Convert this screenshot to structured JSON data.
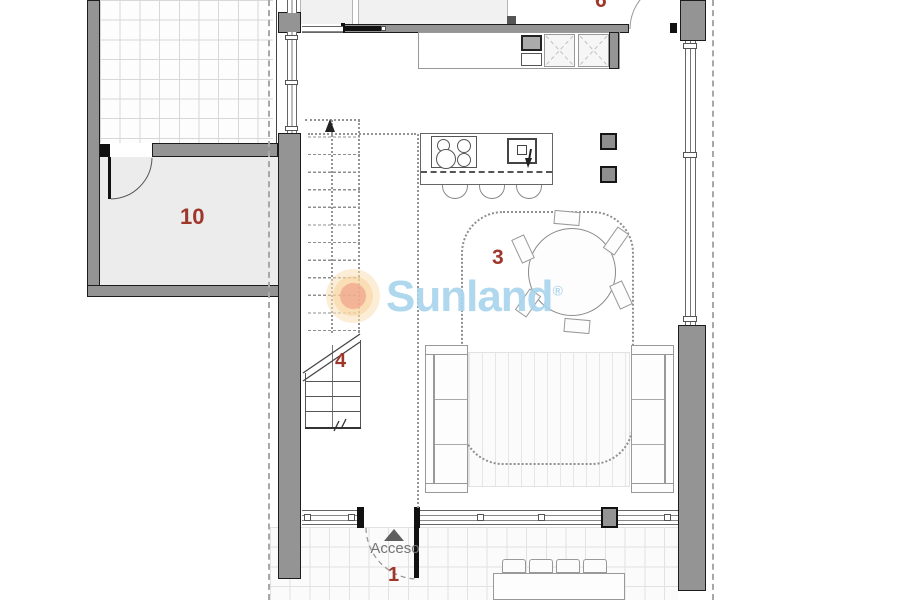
{
  "rooms": {
    "room_10": "10",
    "room_3": "3",
    "room_4": "4",
    "room_1": "1",
    "room_partial_top": "6"
  },
  "entrance": {
    "label": "Acceso"
  },
  "watermark": {
    "brand": "Sunland",
    "registered": "®"
  },
  "colors": {
    "accent_red": "#9e362c",
    "wall_gray": "#949494",
    "room_fill": "#ececec",
    "room_fill_light": "#f1f1f1",
    "grid_line": "#d8d8d8",
    "watermark_blue": "#a9d4ec",
    "logo_outer": "#fae0b4",
    "logo_mid": "#f8cd96",
    "logo_inner": "#ee9b87",
    "text_gray": "#757575",
    "line_dark": "#1c1c1c"
  }
}
